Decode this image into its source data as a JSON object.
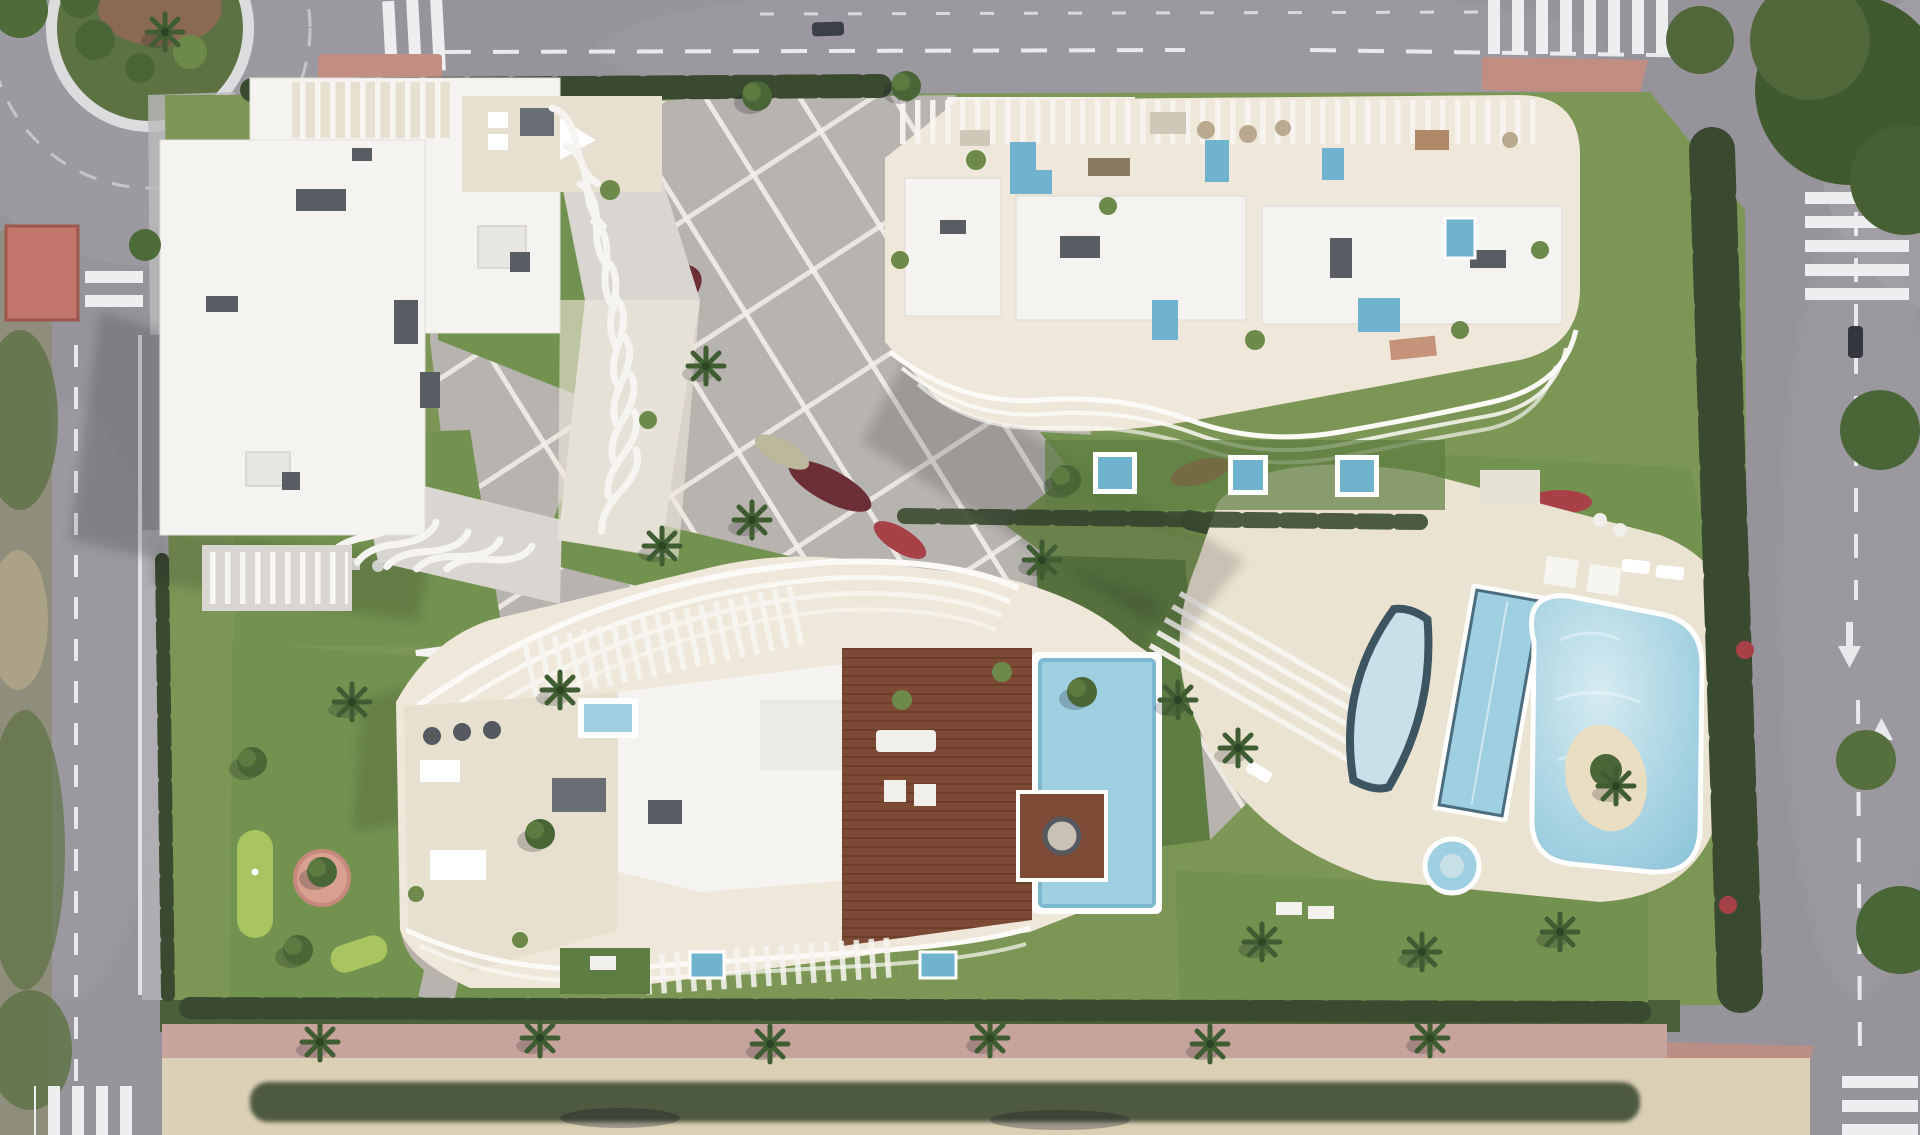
{
  "scene": {
    "type": "aerial-architectural-render",
    "description": "Top-down daytime rendering of a gated residential complex with three sculptural white apartment buildings, a paved central plaza with diagonal white banding, landscaped gardens, a lagoon-style pool area, a rooftop pool on a wooden deck, a mini-golf lawn, perimeter hedges and surrounding asphalt roads with zebra crossings and a planted roundabout.",
    "buildings": [
      {
        "id": "building-northwest",
        "features": "white roof volumes, curved balcony fins, rooftop pergola terrace"
      },
      {
        "id": "building-northeast",
        "features": "cream penthouse terraces, plunge pools, wavy south balconies, slatted north railing"
      },
      {
        "id": "building-south",
        "features": "arched pergola roof, wooden deck, rooftop pool with island lounge, scalloped terraces"
      }
    ],
    "pools": [
      {
        "id": "lagoon-pool",
        "style": "organic lagoon with sand island"
      },
      {
        "id": "lap-pool",
        "style": "long rectangular"
      },
      {
        "id": "half-moon-pool",
        "style": "dark-rimmed crescent"
      },
      {
        "id": "kids-pool",
        "style": "small round"
      },
      {
        "id": "rooftop-pool",
        "style": "rectangular on wood deck with island platform"
      },
      {
        "id": "plunge-pools",
        "style": "small private terrace pools"
      }
    ],
    "roads": [
      {
        "id": "road-top",
        "markings": "dashed centre line, zebra crossings"
      },
      {
        "id": "road-right",
        "markings": "dashed lane line, direction arrows, zebra crossings"
      },
      {
        "id": "road-left",
        "markings": "dashed centre line, solid edge line"
      },
      {
        "id": "roundabout-northwest",
        "markings": "planted centre island, white curb ring"
      }
    ],
    "landscape": [
      "central-plaza",
      "mini-golf-lawn",
      "loungers-lawn",
      "gym-lawn",
      "flower-beds",
      "palm-trees",
      "perimeter-hedge",
      "beach-promenade"
    ]
  },
  "palette": {
    "asphalt": "#96949a",
    "asphalt-light": "#a7a5ab",
    "sidewalk": "#bcbabd",
    "road-line": "#e9e9ec",
    "zebra": "#eceef0",
    "red-sidewalk": "#c28e83",
    "red-roof": "#c2766b",
    "red-roof-edge": "#9e564c",
    "shoulder": "#8f8d7c",
    "shoulder-green": "#5d7243",
    "paving": "#b7b3ae",
    "paving-light": "#c9c5be",
    "grid-line": "#f2efe9",
    "lawn": "#74924f",
    "lawn-dark": "#5e7d42",
    "lawn-bright": "#a9c561",
    "hedge": "#3a4a30",
    "tree": "#4a6637",
    "tree-hi": "#6d8a4a",
    "palm": "#3f5c33",
    "flower-red": "#a84048",
    "flower-burgundy": "#6d2f36",
    "flower-purple": "#6f5a93",
    "flower-white": "#c9cdbd",
    "bld-white": "#f5f3ef",
    "bld-cream": "#efe8da",
    "terrace": "#e7e0d0",
    "fin-base": "#d9d6d2",
    "vent": "#585d64",
    "wood": "#7d4a35",
    "wood-dark": "#5f3526",
    "water": "#9fd0e2",
    "water-deep": "#6fb3cf",
    "water-pale": "#c8e0e8",
    "pool-rim-dark": "#3c5560",
    "sand": "#dbcfb6",
    "island-sand": "#e9ddc2",
    "pink-walk": "#c7a39e",
    "deck": "#ebe3d2",
    "shadow": "#14141e"
  }
}
